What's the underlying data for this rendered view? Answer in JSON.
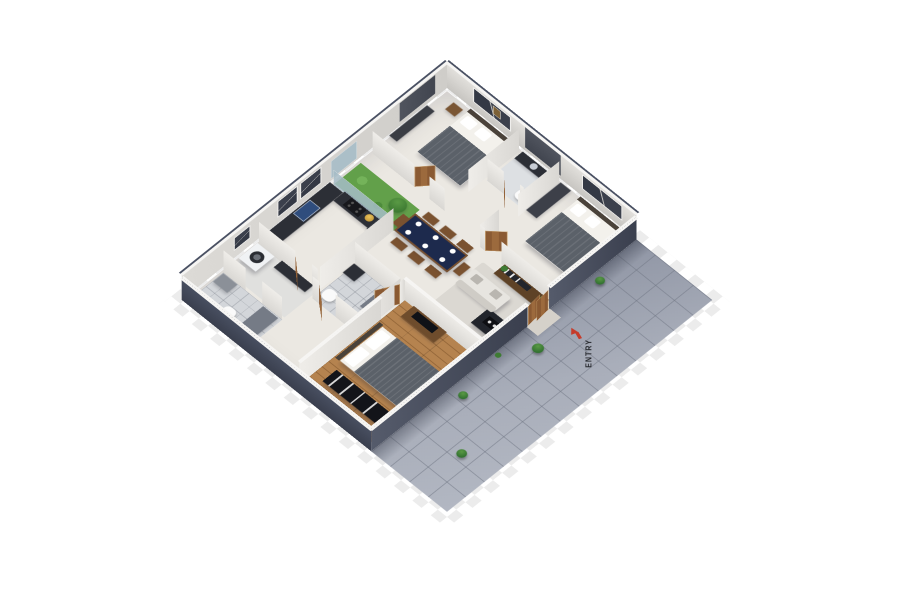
{
  "labels": {
    "entry": "ENTRY"
  },
  "icons": {
    "entry_arrow": "red arrow pointing toward entry door (css triangle + stem)",
    "washer_door": "front-loader round door (css circle)"
  },
  "colors": {
    "bg": "#ffffff",
    "checker": "#ececec",
    "outer_wall": "#4a5163",
    "outer_wall_dark": "#3a3f4e",
    "inner_wall": "#efede9",
    "wall_cap": "#f6f5f3",
    "floor": "#ebe8e2",
    "wood": "#b5834f",
    "wood_seam": "#96683a",
    "tile": "#9aa0ae",
    "tile_line": "#78808f",
    "navy_table": "#1d2a4d",
    "sofa": "#e7e5e0",
    "blanket": "#5b6169",
    "bed_sheet": "#f3f1ec",
    "garden": "#62a04a",
    "tree": "#3e7b33",
    "door": "#8a5a33",
    "door_light": "#c9a06a",
    "dark_unit": "#22252c",
    "black_unit": "#131419",
    "counter": "#2c2f36",
    "sink": "#2f4d7d",
    "accent_red": "#c63b2a",
    "text": "#23252a",
    "washer": "#f0f2f4",
    "fixture_gray": "#8b9098",
    "bath_floor": "#d3d6da"
  }
}
